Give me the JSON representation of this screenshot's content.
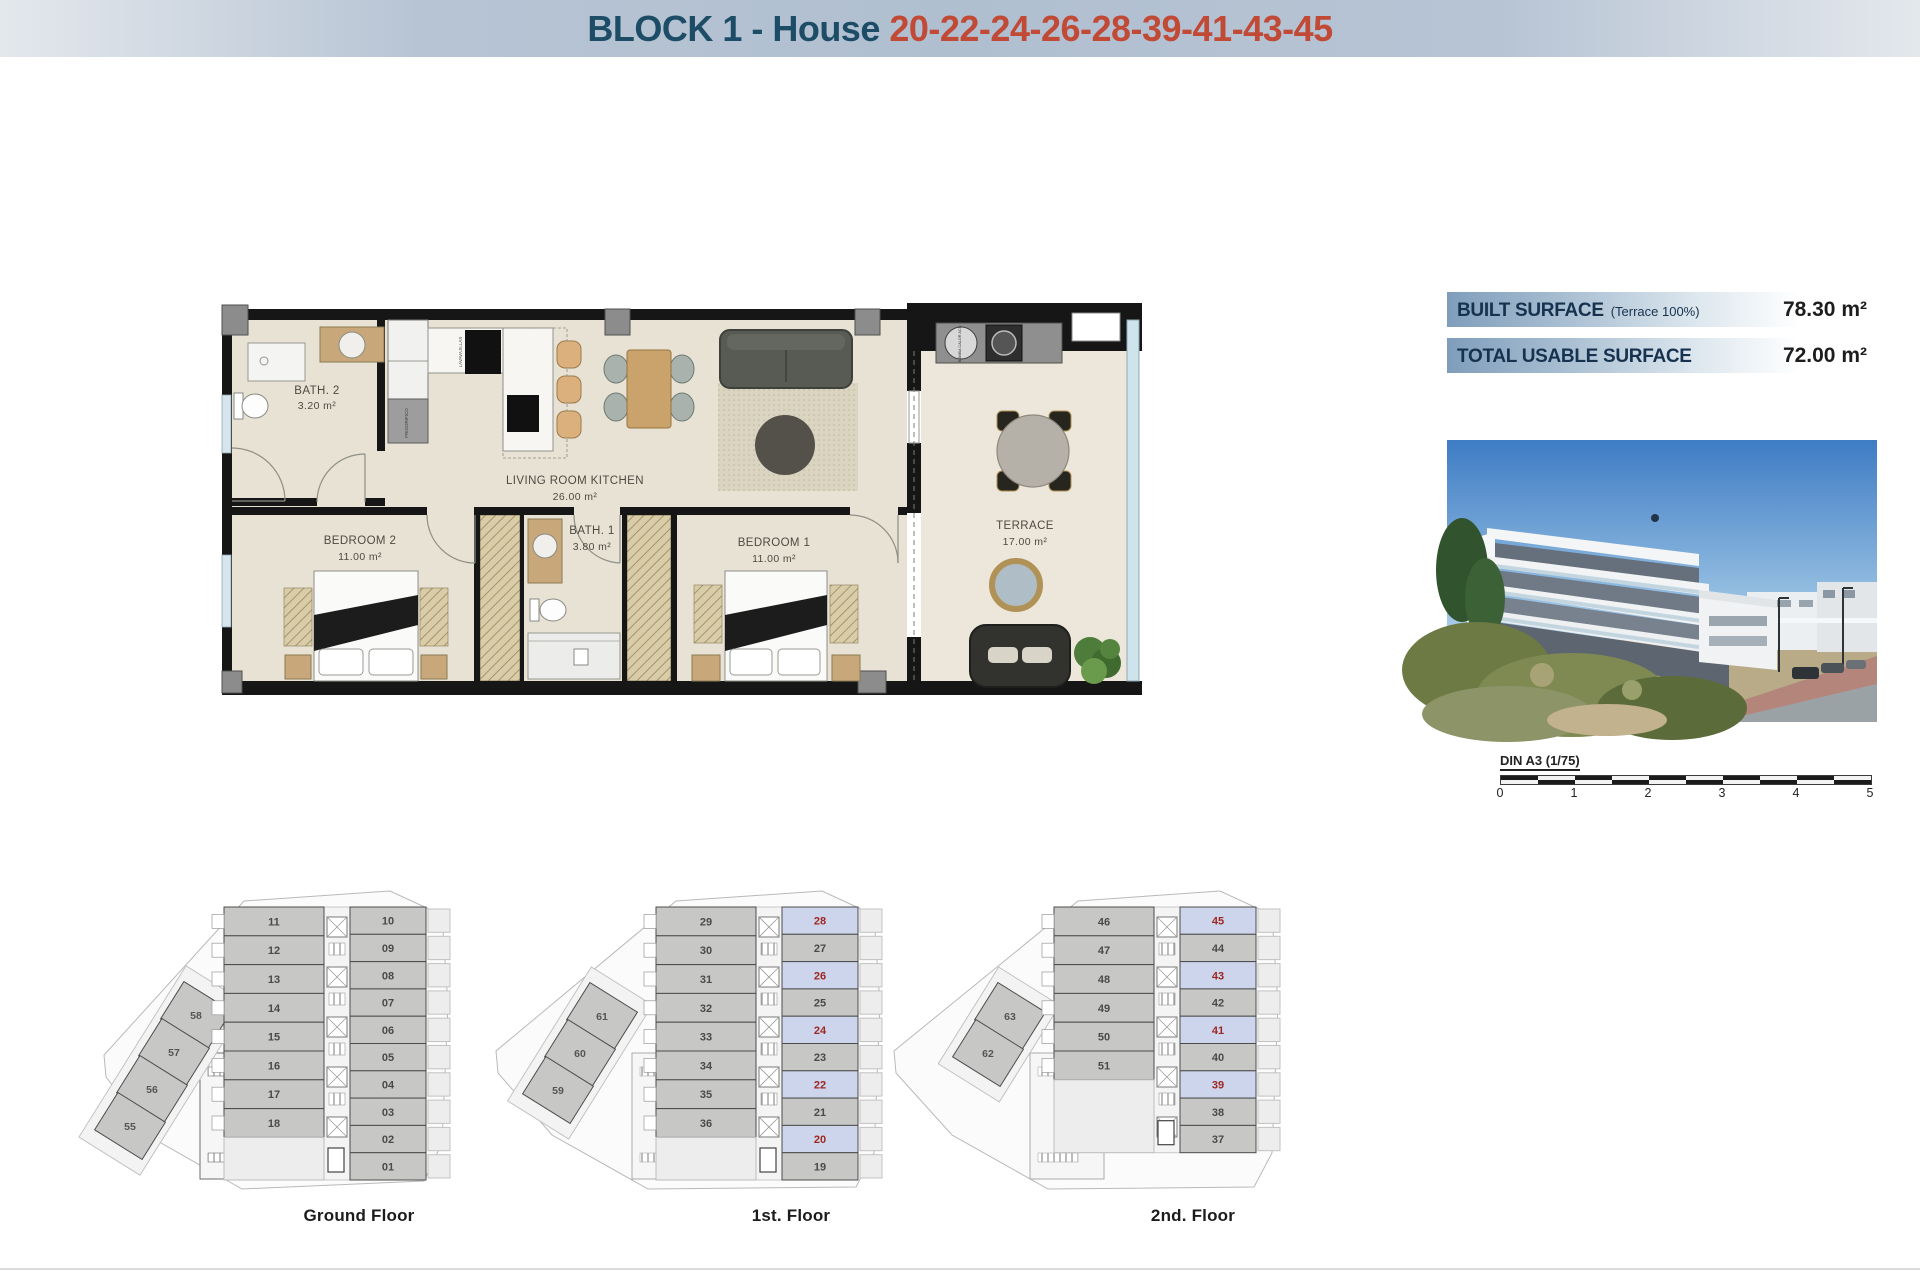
{
  "header": {
    "title_left": "BLOCK 1 - House ",
    "title_numbers": "20-22-24-26-28-39-41-43-45"
  },
  "surface": {
    "built_label": "BUILT SURFACE",
    "built_note": "(Terrace 100%)",
    "built_value": "78.30 m²",
    "usable_label": "TOTAL USABLE SURFACE",
    "usable_value": "72.00 m²"
  },
  "plan": {
    "rooms": [
      {
        "id": "bath2",
        "name": "BATH. 2",
        "area": "3.20 m²"
      },
      {
        "id": "living",
        "name": "LIVING ROOM KITCHEN",
        "area": "26.00 m²"
      },
      {
        "id": "bedroom2",
        "name": "BEDROOM 2",
        "area": "11.00 m²"
      },
      {
        "id": "bath1",
        "name": "BATH. 1",
        "area": "3.80 m²"
      },
      {
        "id": "bedroom1",
        "name": "BEDROOM 1",
        "area": "11.00 m²"
      },
      {
        "id": "terrace",
        "name": "TERRACE",
        "area": "17.00 m²"
      }
    ],
    "appliances": {
      "dishwasher": "LAVAVAJILLAS",
      "fridge": "FRIGORIFICO",
      "heat_pump": "BOMBA CALOR ACS"
    }
  },
  "scalebar": {
    "title": "DIN A3 (1/75)",
    "ticks": [
      "0",
      "1",
      "2",
      "3",
      "4",
      "5"
    ]
  },
  "floors": [
    {
      "label": "Ground Floor",
      "diagonal": [
        "58",
        "57",
        "56",
        "55"
      ],
      "left": [
        "11",
        "12",
        "13",
        "14",
        "15",
        "16",
        "17",
        "18"
      ],
      "right": [
        {
          "n": "10"
        },
        {
          "n": "09"
        },
        {
          "n": "08"
        },
        {
          "n": "07"
        },
        {
          "n": "06"
        },
        {
          "n": "05"
        },
        {
          "n": "04"
        },
        {
          "n": "03"
        },
        {
          "n": "02"
        },
        {
          "n": "01"
        }
      ]
    },
    {
      "label": "1st. Floor",
      "diagonal": [
        "61",
        "60",
        "59"
      ],
      "left": [
        "29",
        "30",
        "31",
        "32",
        "33",
        "34",
        "35",
        "36"
      ],
      "right": [
        {
          "n": "28",
          "hl": true
        },
        {
          "n": "27"
        },
        {
          "n": "26",
          "hl": true
        },
        {
          "n": "25"
        },
        {
          "n": "24",
          "hl": true
        },
        {
          "n": "23"
        },
        {
          "n": "22",
          "hl": true
        },
        {
          "n": "21"
        },
        {
          "n": "20",
          "hl": true
        },
        {
          "n": "19"
        }
      ]
    },
    {
      "label": "2nd. Floor",
      "diagonal": [
        "63",
        "62"
      ],
      "left": [
        "46",
        "47",
        "48",
        "49",
        "50",
        "51"
      ],
      "right": [
        {
          "n": "45",
          "hl": true
        },
        {
          "n": "44"
        },
        {
          "n": "43",
          "hl": true
        },
        {
          "n": "42"
        },
        {
          "n": "41",
          "hl": true
        },
        {
          "n": "40"
        },
        {
          "n": "39",
          "hl": true
        },
        {
          "n": "38"
        },
        {
          "n": "37"
        }
      ]
    }
  ],
  "colors": {
    "header_text": "#1d4d66",
    "header_numbers": "#c14a37",
    "unit_fill": "#c7c7c5",
    "unit_number": "#4a4a4a",
    "highlight_fill": "#cdd5ec",
    "highlight_number": "#9e2620",
    "surface_band": "#7f9dbb"
  }
}
